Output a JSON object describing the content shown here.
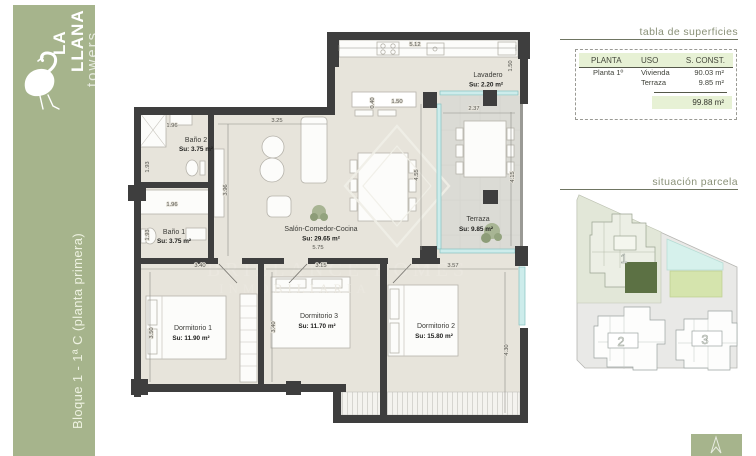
{
  "colors": {
    "brand_green": "#a6b48c",
    "highlight_unit_green": "#5c7144",
    "table_header_green": "#e7f1d5",
    "wall_dark": "#3e3e3e"
  },
  "sidebar": {
    "brand": {
      "line1": "LA",
      "line2": "LLANA",
      "line3": "towers"
    },
    "block_label": "Bloque 1 - 1ª C (planta primera)"
  },
  "surfaces": {
    "title": "tabla de superficies",
    "headers": {
      "planta": "PLANTA",
      "uso": "USO",
      "sconst": "S. CONST."
    },
    "rows": [
      {
        "planta": "Planta 1º",
        "uso": "Vivienda",
        "value": "90.03 m²"
      },
      {
        "planta": "",
        "uso": "Terraza",
        "value": "9.85 m²"
      }
    ],
    "total": "99.88 m²"
  },
  "parcel": {
    "title": "situación parcela",
    "block1": "1",
    "block2": "2",
    "block3": "3"
  },
  "plan": {
    "rooms": {
      "bano2": {
        "name": "Baño 2",
        "area": "Su: 3.75 m²"
      },
      "bano1": {
        "name": "Baño 1",
        "area": "Su: 3.75 m²"
      },
      "salon": {
        "name": "Salón-Comedor-Cocina",
        "area": "Su: 29.65 m²"
      },
      "lavadero": {
        "name": "Lavadero",
        "area": "Su: 2.20 m²"
      },
      "terraza": {
        "name": "Terraza",
        "area": "Su: 9.85 m²"
      },
      "dorm1": {
        "name": "Dormitorio 1",
        "area": "Su: 11.90 m²"
      },
      "dorm3": {
        "name": "Dormitorio 3",
        "area": "Su: 11.70 m²"
      },
      "dorm2": {
        "name": "Dormitorio 2",
        "area": "Su: 15.80 m²"
      }
    },
    "dims": {
      "kitchen_top": "5.12",
      "lavadero_h": "1.50",
      "peninsula_d": "0.40",
      "peninsula_w": "1.50",
      "terraza_top": "2.37",
      "terraza_left": "4.55",
      "terraza_right": "4.15",
      "salon_left": "3.25",
      "salon_bottom": "5.75",
      "hall": "3.96",
      "bano2_w": "1.96",
      "bano2_h": "1.93",
      "bano1_w": "1.96",
      "bano1_h": "1.93",
      "dorm1_w": "3.40",
      "dorm1_h": "3.50",
      "dorm3_w": "3.15",
      "dorm3_h": "3.40",
      "dorm2_w": "3.57",
      "dorm2_h": "4.30"
    },
    "watermark": {
      "line1": "BRILLANCE HOMES",
      "line2": "INMOBILIARIA"
    }
  }
}
